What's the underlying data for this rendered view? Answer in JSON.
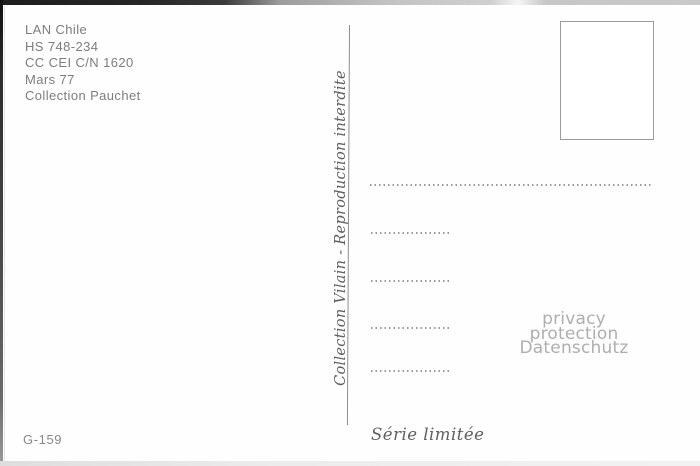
{
  "postcard": {
    "publisher_block": {
      "lines": [
        "LAN Chile",
        "HS 748-234",
        "CC CEI C/N 1620",
        "Mars 77",
        "Collection Pauchet"
      ]
    },
    "vertical_note": "Collection Vilain - Reproduction interdite",
    "catalog_number": "G-159",
    "series_label": "Série limitée",
    "watermark": {
      "line1": "privacy protection",
      "line2": "Datenschutz"
    }
  },
  "colors": {
    "publisher_text": "#7d7d7d",
    "script_text": "#5f5f5f",
    "watermark_text": "#aeaeae",
    "dotted_line": "#999999",
    "stamp_box_border": "#9b9b9b",
    "divider_line": "#8e8e8e"
  }
}
